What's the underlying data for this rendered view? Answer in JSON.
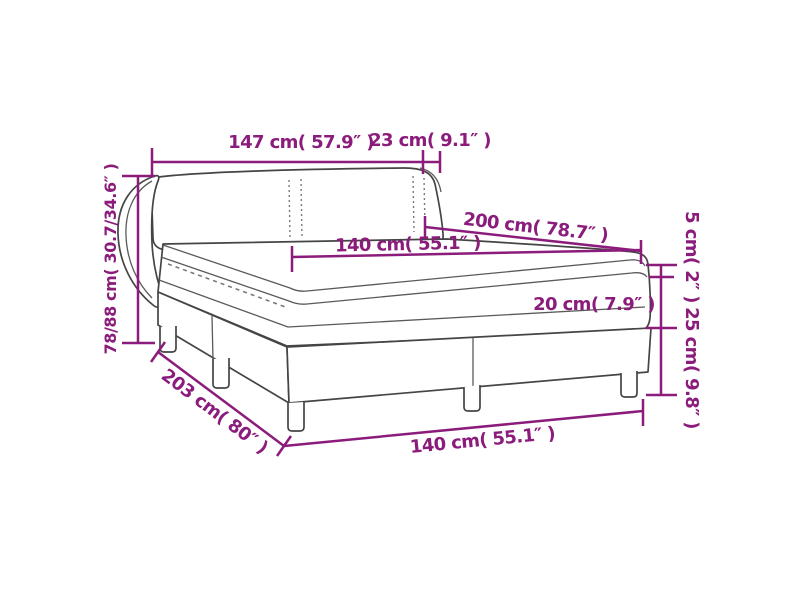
{
  "title": "Box spring bed dimension diagram",
  "colors": {
    "dimension_accent": "#8b1c7c",
    "bed_outline": "#454545",
    "background": "#ffffff"
  },
  "labels": {
    "headboard_width": "147 cm( 57.9″ )",
    "headboard_side_depth": "23 cm( 9.1″ )",
    "mattress_length": "200 cm( 78.7″ )",
    "mattress_width": "140 cm( 55.1″ )",
    "bed_height_range": "78/88 cm( 30.7/34.6″ )",
    "topper_height": "5 cm( 2″ )",
    "mattress_height": "20 cm( 7.9″ )",
    "base_height": "25 cm( 9.8″ )",
    "bed_length": "203 cm( 80″ )",
    "bed_width": "140 cm( 55.1″ )"
  }
}
